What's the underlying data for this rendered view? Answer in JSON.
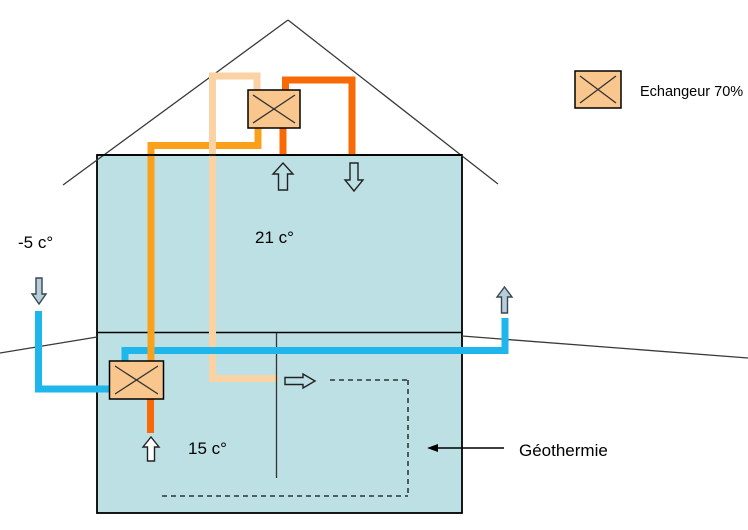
{
  "labels": {
    "outside_temp": "-5 c°",
    "room_temp": "21 c°",
    "basement_temp": "15 c°",
    "geothermal": "Géothermie",
    "legend_exchanger": "Echangeur 70%"
  },
  "colors": {
    "house_fill": "#BDE0E4",
    "exchanger_fill": "#F9C68D",
    "pipe_blue": "#1FB6EC",
    "pipe_orange": "#F9A11B",
    "pipe_dark_orange": "#F96A07",
    "pipe_peach": "#FAD2A4",
    "outdoor_arrow_fill": "#B7CDDB",
    "line": "#000000"
  }
}
